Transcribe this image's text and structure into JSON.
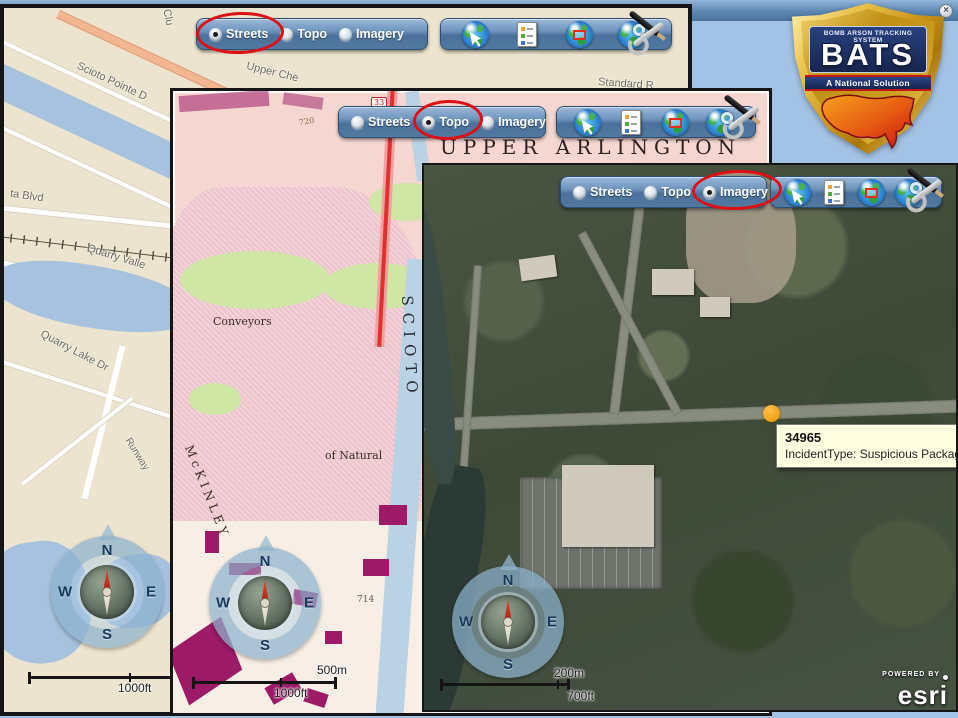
{
  "logo": {
    "banner_top": "Bomb Arson Tracking System",
    "acronym": "BATS",
    "banner_bottom": "A National Solution"
  },
  "basemap_options": [
    "Streets",
    "Topo",
    "Imagery"
  ],
  "compass": {
    "north": "N",
    "east": "E",
    "south": "S",
    "west": "W"
  },
  "streets_window": {
    "selected_basemap": "Streets",
    "scalebar": {
      "imperial": "1000ft"
    },
    "labels": {
      "club": "Clu",
      "scioto_pointe": "Scioto Pointe D",
      "upper_che": "Upper Che",
      "standard_rd": "Standard R",
      "ta_blvd": "ta Blvd",
      "quarry_valley": "Quarry Valle",
      "quarry_lake_dr": "Quarry Lake Dr",
      "runway": "Runway"
    }
  },
  "topo_window": {
    "selected_basemap": "Topo",
    "scalebar": {
      "metric": "500m",
      "imperial": "1000ft"
    },
    "labels": {
      "city": "UPPER ARLINGTON",
      "conveyors": "Conveyors",
      "mckinley": "McKINLEY",
      "scioto": "SCIOTO",
      "of_natural": "of Natural",
      "route_shield": "33",
      "contour_720": "720",
      "contour_714": "714"
    }
  },
  "imagery_window": {
    "selected_basemap": "Imagery",
    "scalebar": {
      "metric": "200m",
      "imperial": "700ft"
    },
    "attribution": {
      "powered_by": "POWERED BY",
      "brand": "esri"
    },
    "incident_popup": {
      "id": "34965",
      "detail": "IncidentType: Suspicious Package/"
    }
  },
  "overview_map": {
    "title": "Overview Map",
    "close_glyph": "×",
    "labels": {
      "waltham_rd": "Waltham Rd",
      "arlington_ave": "Arlington Ave",
      "w_5": "W 5",
      "w": "W",
      "grandview": "Grandview Heigh"
    }
  }
}
